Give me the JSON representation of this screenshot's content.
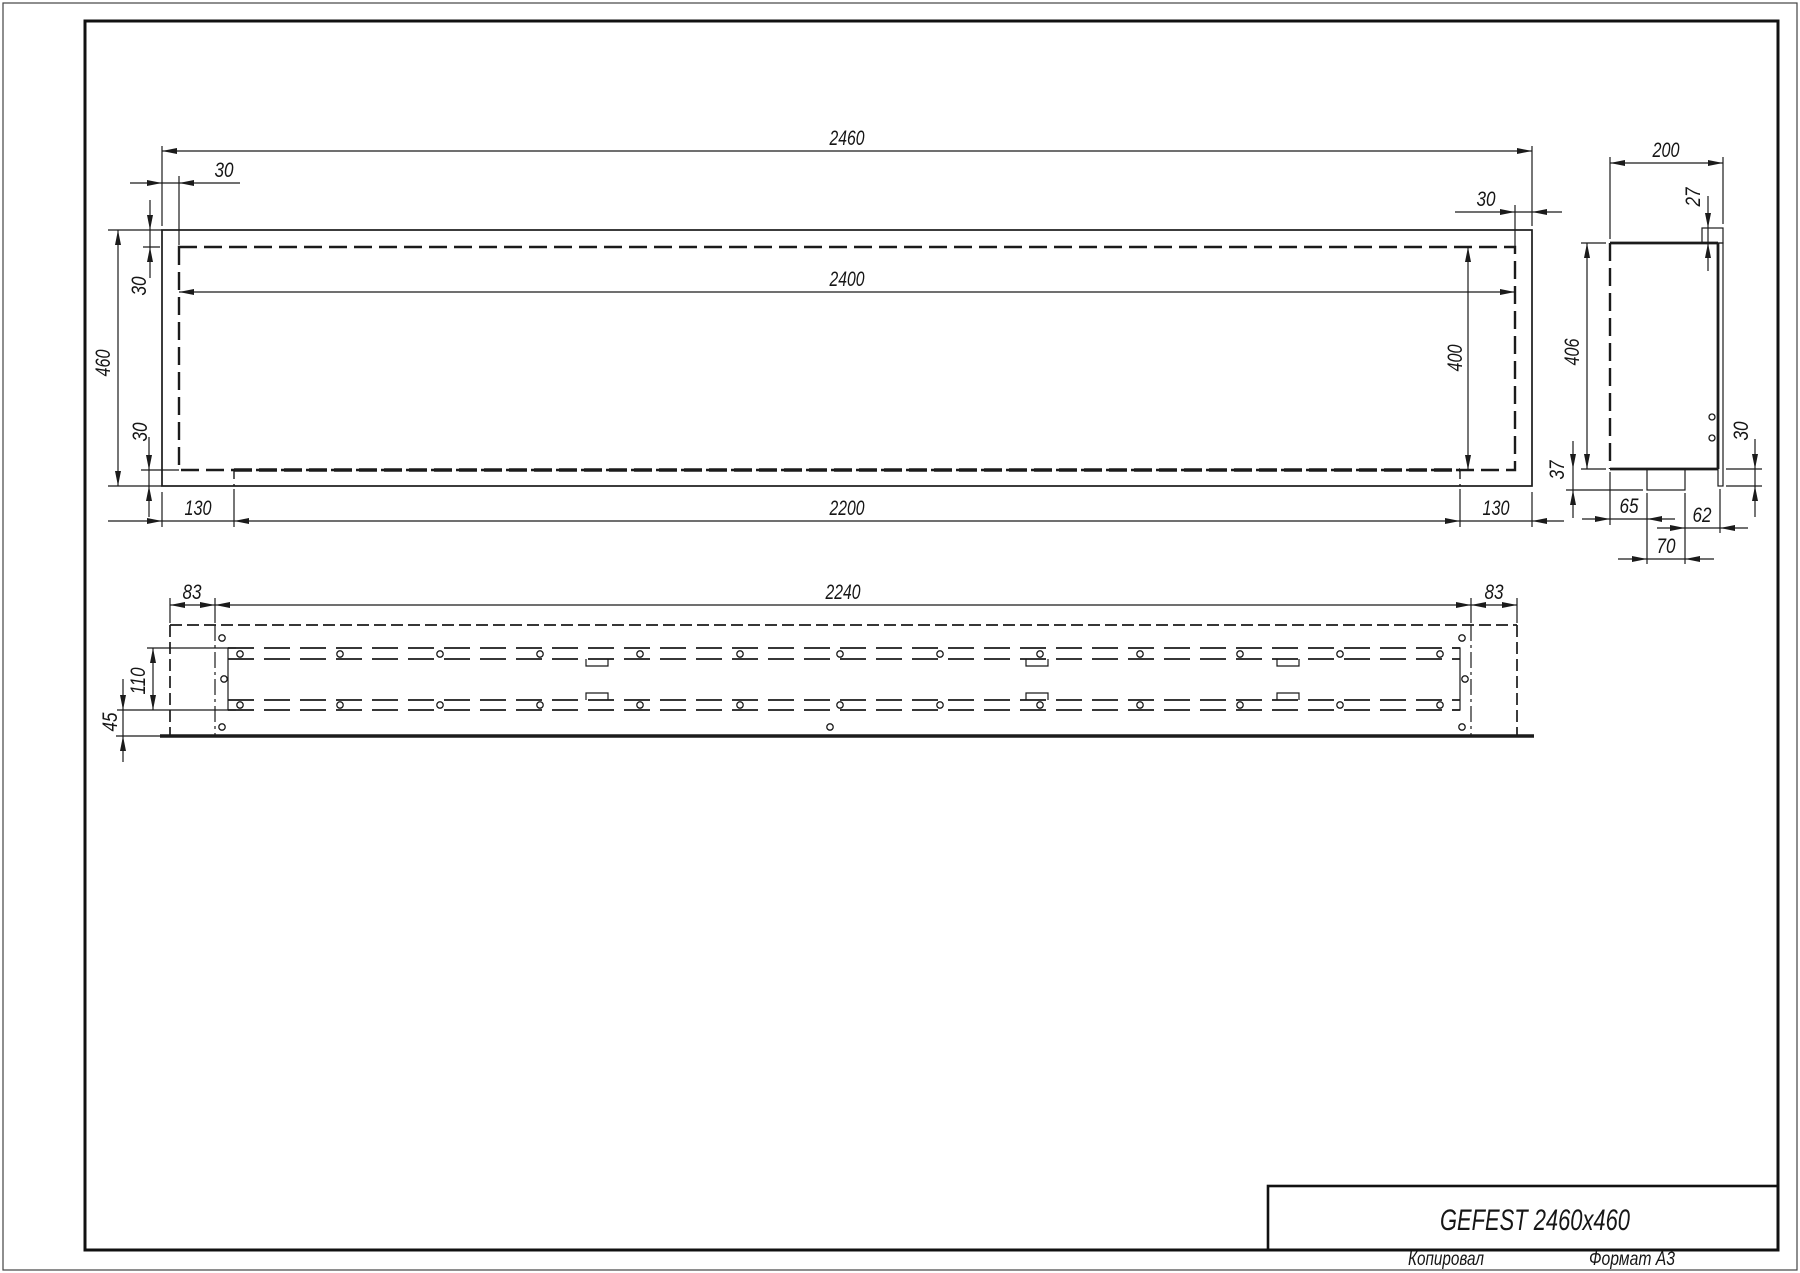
{
  "colors": {
    "line": "#1b1b1b",
    "background": "#ffffff"
  },
  "front_view": {
    "dims": {
      "overall_width": "2460",
      "opening_width": "2400",
      "overall_height": "460",
      "opening_height": "400",
      "margin_left": "30",
      "margin_top": "30",
      "margin_bottom": "30",
      "margin_right": "30",
      "tray_length": "2200",
      "tray_inset_left": "130",
      "tray_inset_right": "130"
    }
  },
  "side_view": {
    "dims": {
      "depth": "200",
      "flange_lip": "27",
      "body_height": "406",
      "tray_drop": "37",
      "bottom_margin": "30",
      "seg_left": "65",
      "seg_right": "62",
      "tray_width": "70"
    }
  },
  "bottom_view": {
    "dims": {
      "liner_length": "2240",
      "liner_inset_left": "83",
      "liner_inset_right": "83",
      "slot_width": "110",
      "front_offset": "45"
    }
  },
  "title_block": {
    "model": "GEFEST 2460x460",
    "copied_by_label": "Копировал",
    "format_label": "Формат А3"
  }
}
